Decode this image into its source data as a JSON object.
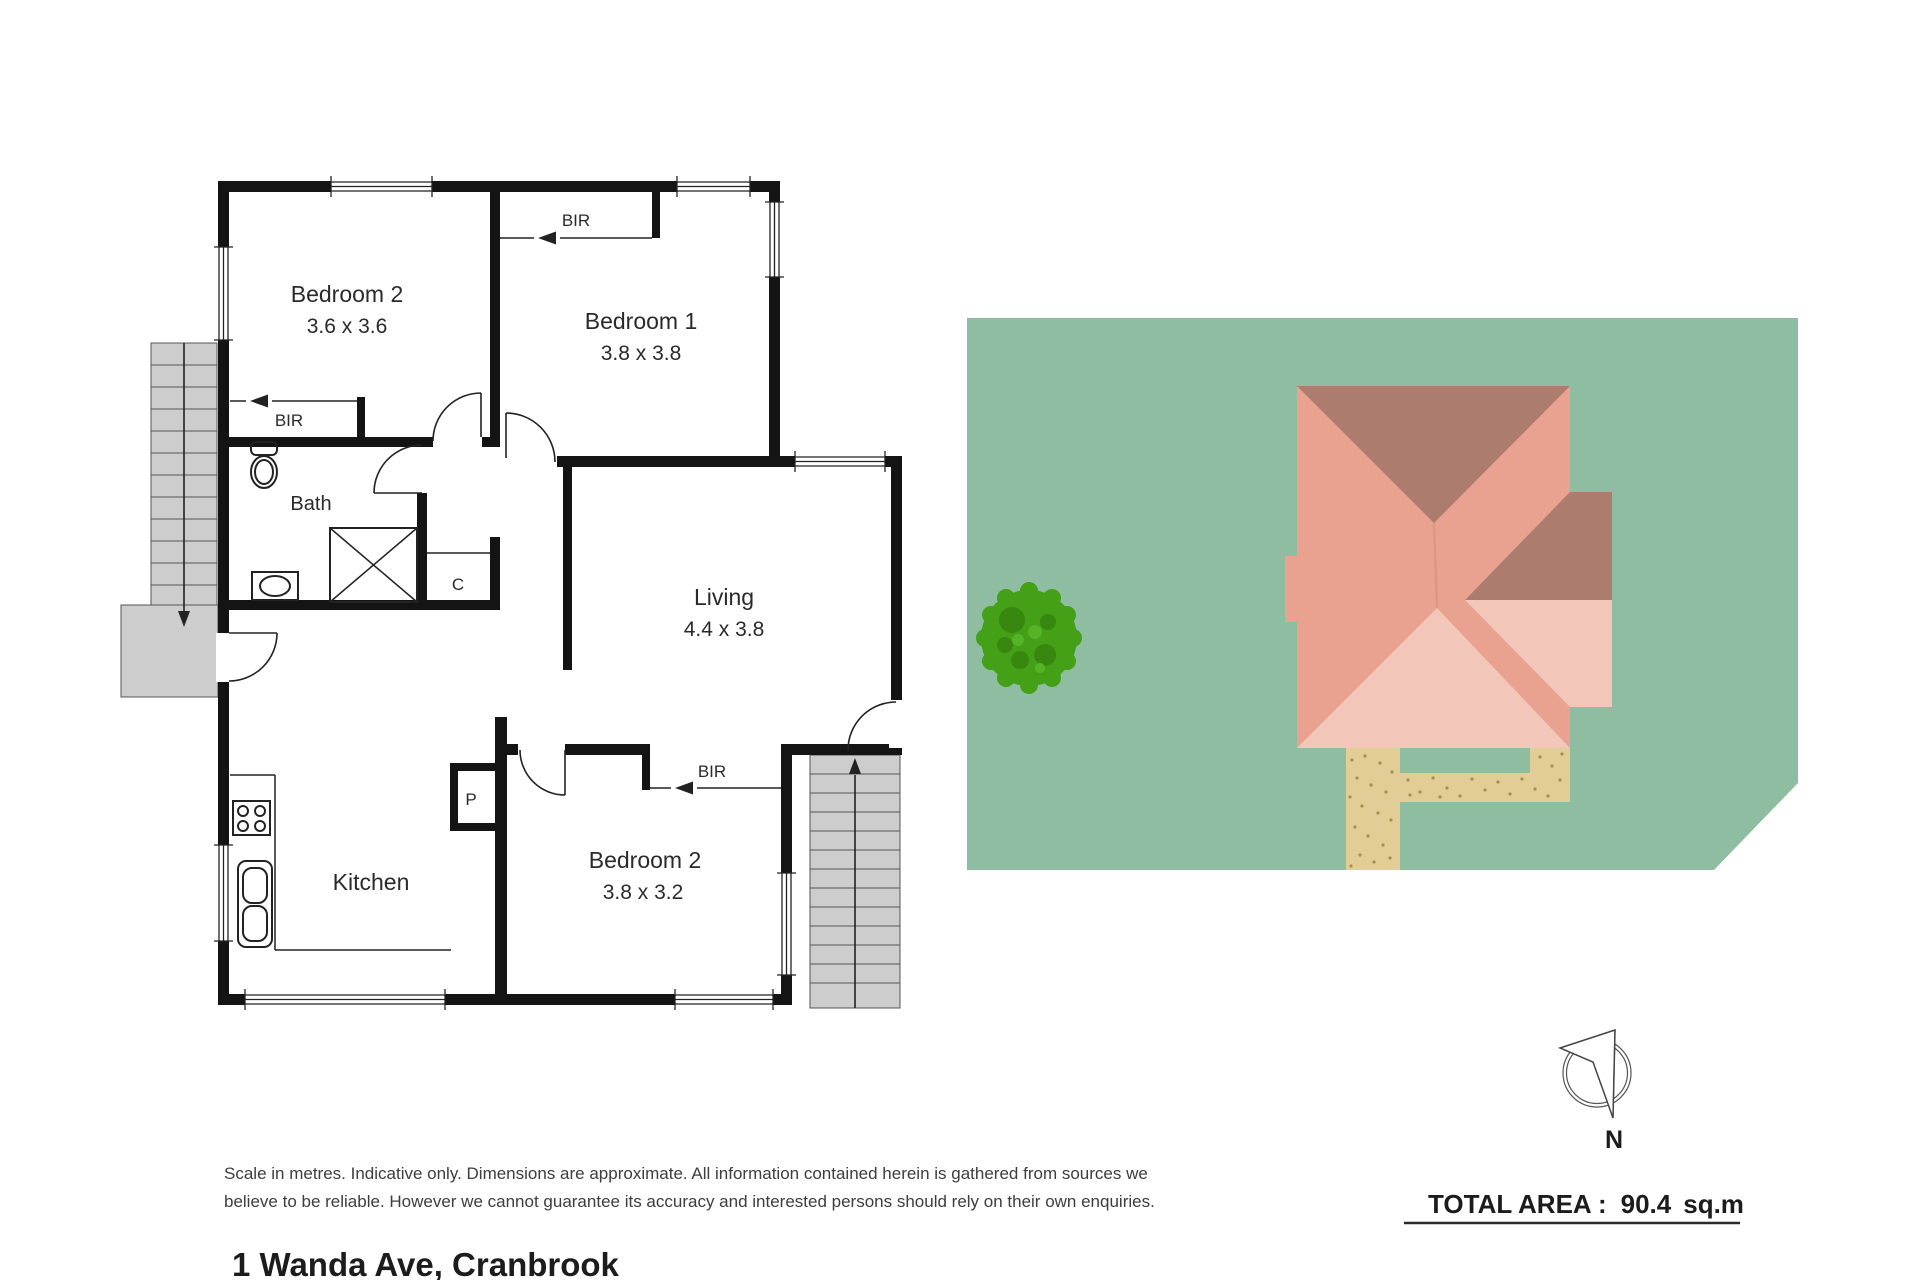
{
  "address": "1 Wanda Ave, Cranbrook",
  "disclaimer": {
    "line1": "Scale in metres. Indicative only. Dimensions are approximate. All information contained herein is gathered from sources we",
    "line2": "believe to be reliable. However we cannot guarantee its accuracy and interested persons should rely on their own enquiries."
  },
  "summary": {
    "label": "TOTAL AREA :",
    "value": "90.4",
    "unit": "sq.m"
  },
  "compass": {
    "north_label": "N"
  },
  "floorplan": {
    "rooms": {
      "bedroom2_top": {
        "name": "Bedroom 2",
        "dims": "3.6 x 3.6"
      },
      "bedroom1": {
        "name": "Bedroom 1",
        "dims": "3.8 x 3.8"
      },
      "living": {
        "name": "Living",
        "dims": "4.4 x 3.8"
      },
      "bath": {
        "name": "Bath"
      },
      "kitchen": {
        "name": "Kitchen"
      },
      "bedroom2_bottom": {
        "name": "Bedroom 2",
        "dims": "3.8 x 3.2"
      }
    },
    "labels": {
      "built_in_robe": "BIR",
      "cupboard": "C",
      "pantry": "P"
    }
  },
  "colors": {
    "wall": "#141414",
    "stairs_gray": "#cdcdcd",
    "lot_green": "#8fbda1",
    "roof_salmon": "#e8a28f",
    "roof_dark": "#ac7d6e",
    "roof_light": "#f2c6b8",
    "path_tan": "#e2cd96",
    "path_speckle": "#a8904f",
    "tree_green": "#44a117",
    "tree_dark": "#38870e",
    "tree_light": "#55b325"
  }
}
